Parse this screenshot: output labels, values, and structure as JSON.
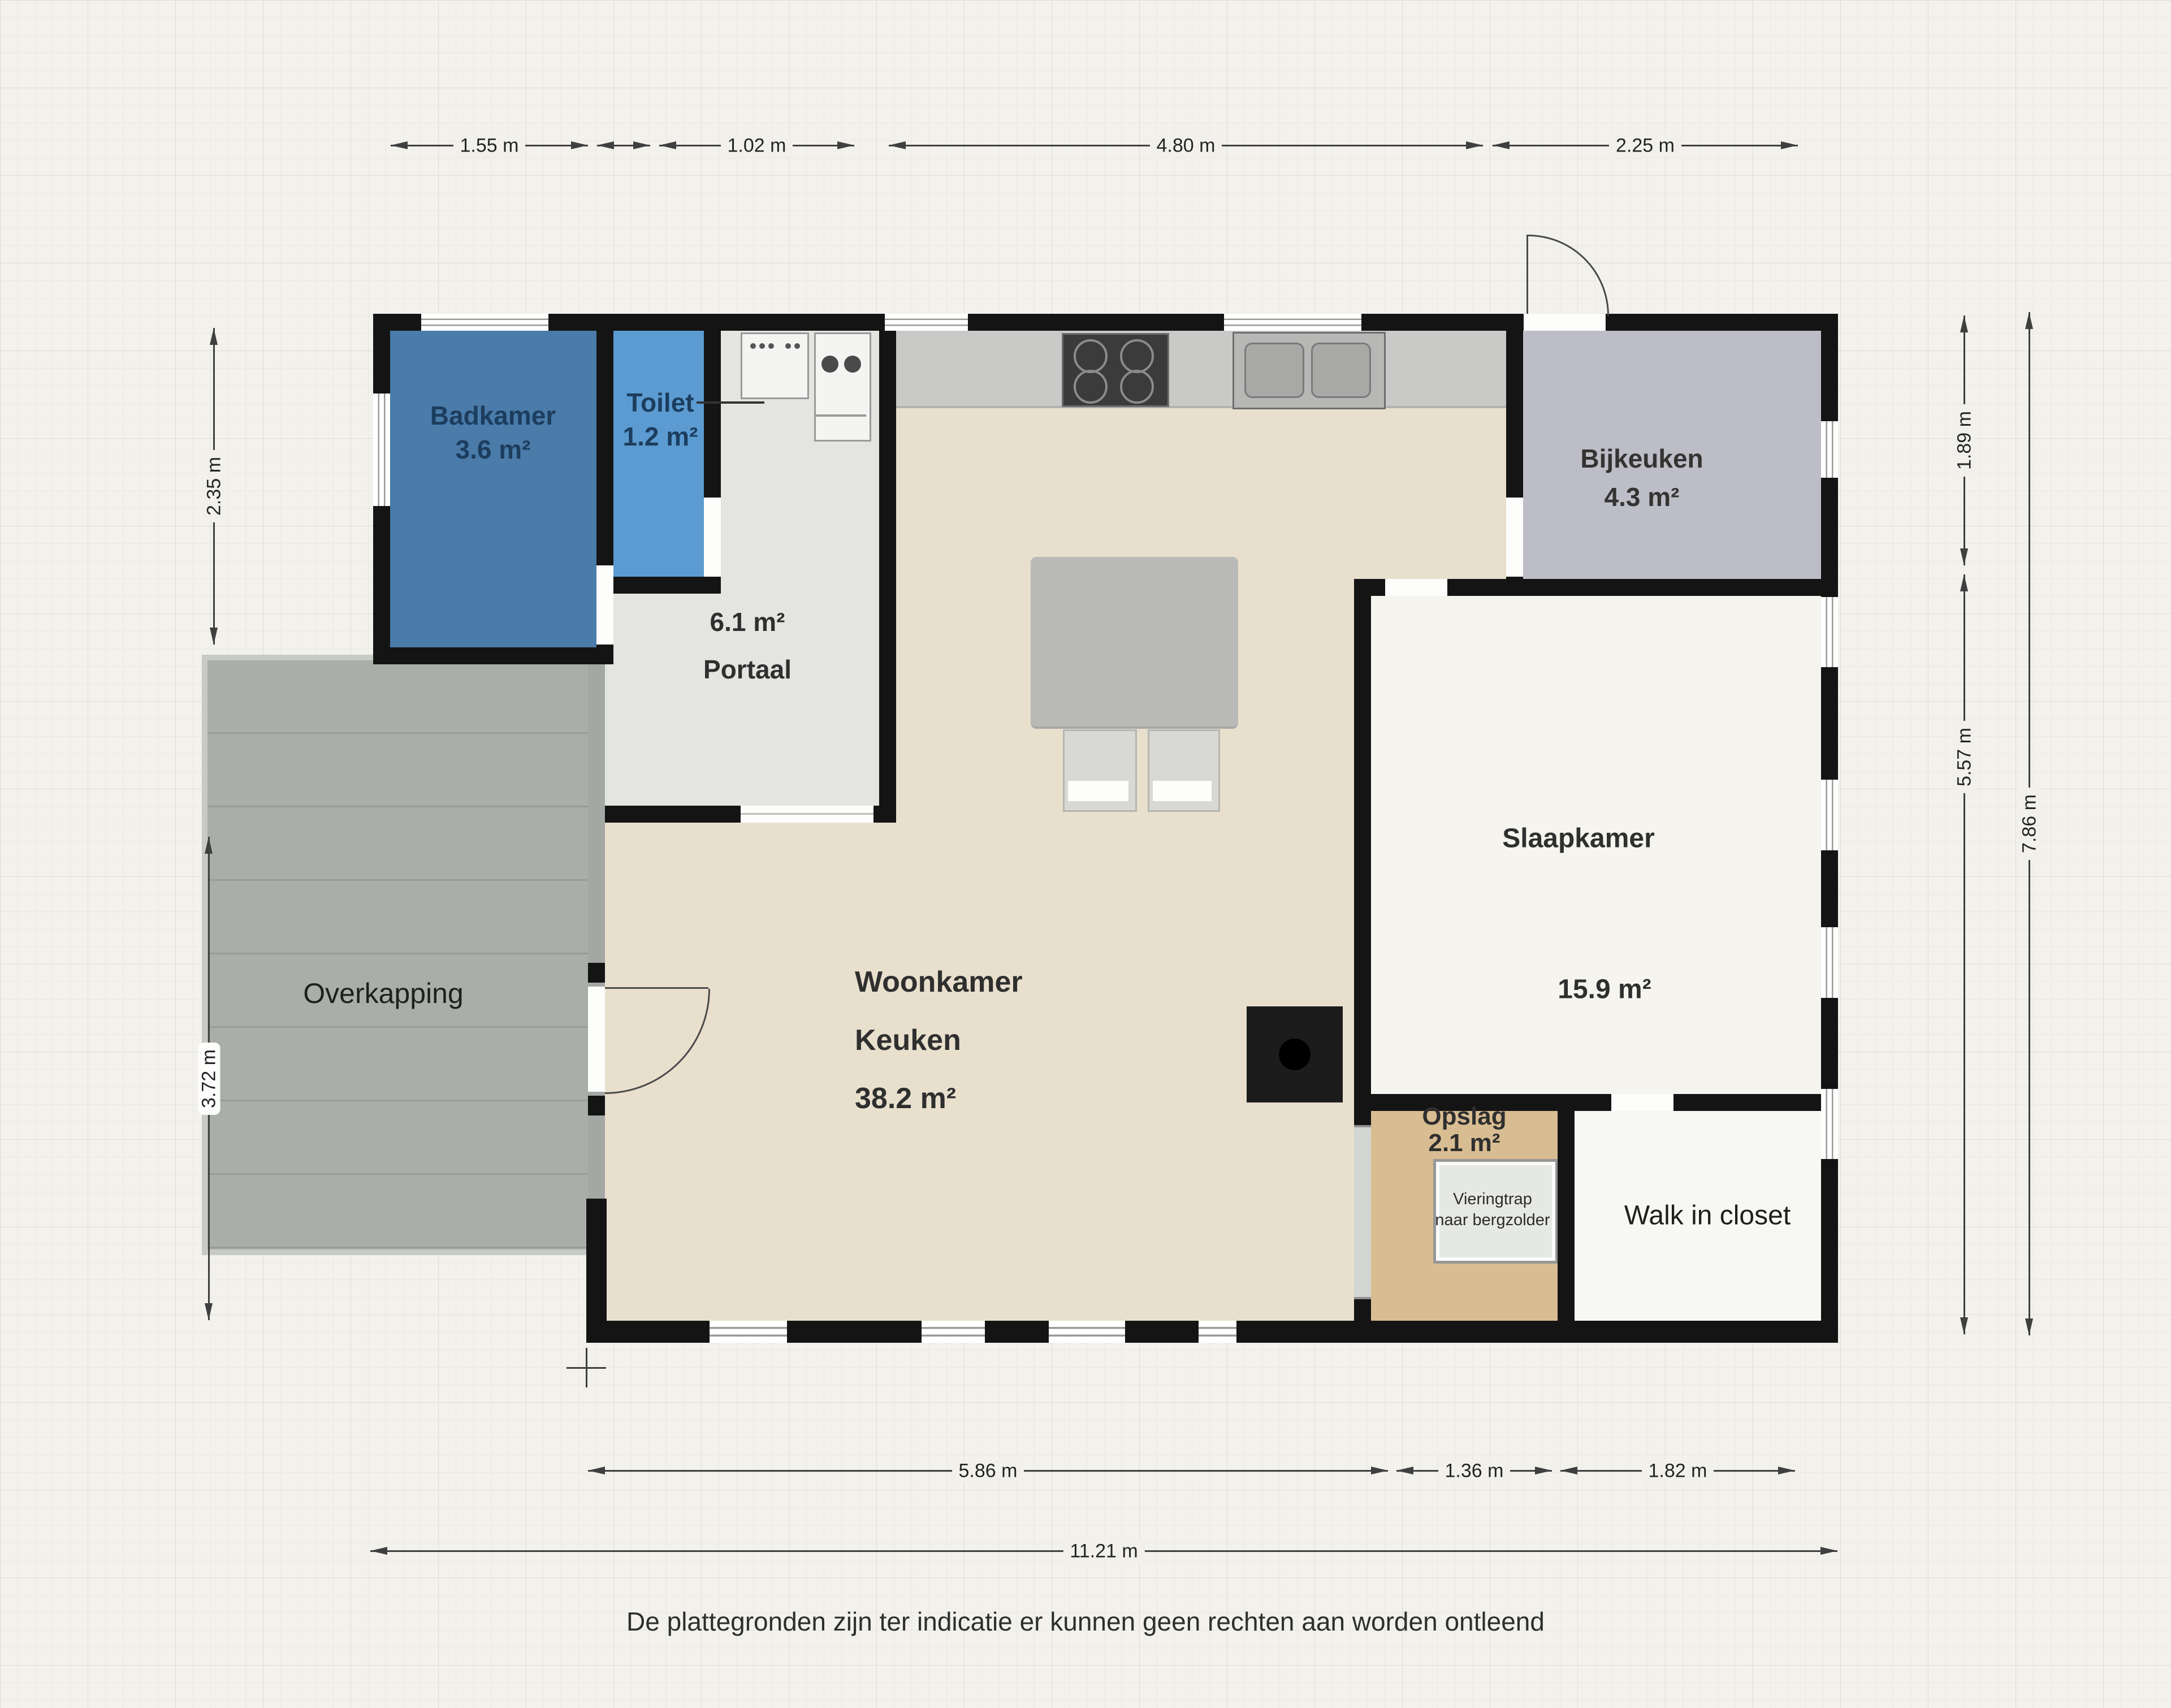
{
  "rooms": {
    "badkamer": {
      "name": "Badkamer",
      "area": "3.6 m²"
    },
    "toilet": {
      "name": "Toilet",
      "area": "1.2 m²"
    },
    "portaal": {
      "area": "6.1 m²",
      "name": "Portaal"
    },
    "bijkeuken": {
      "name": "Bijkeuken",
      "area": "4.3 m²"
    },
    "woonkamer": {
      "line1": "Woonkamer",
      "line2": "Keuken",
      "area": "38.2 m²"
    },
    "slaapkamer": {
      "name": "Slaapkamer",
      "area": "15.9 m²"
    },
    "opslag": {
      "name": "Opslag",
      "area": "2.1 m²"
    },
    "walk_in_closet": {
      "name": "Walk in closet"
    },
    "overkapping": {
      "name": "Overkapping"
    },
    "vieringtrap": {
      "line1": "Vieringtrap",
      "line2": "naar bergzolder"
    }
  },
  "dimensions": {
    "top": [
      "1.55 m",
      "",
      "1.02 m",
      "4.80 m",
      "2.25 m"
    ],
    "left": [
      "2.35 m",
      "3.72 m"
    ],
    "right": [
      "1.89 m",
      "5.57 m",
      "7.86 m"
    ],
    "bottom": [
      "5.86 m",
      "1.36 m",
      "1.82 m",
      "11.21 m"
    ]
  },
  "fixtures": {
    "cooktop": "cooktop-icon",
    "double_sink": "double-sink-icon",
    "washbasin": "washbasin-icon",
    "boiler_sink": "boiler-sink-icon",
    "dining_table": "dining-table",
    "chairs": "chair",
    "wood_stove": "wood-stove-icon",
    "attic_stairs": "attic-stairs-box"
  },
  "colors": {
    "badkamer": "#4a7ba9",
    "toilet": "#5b9bd1",
    "portaal": "#e4e5e1",
    "bijkeuken": "#bdbdc7",
    "woonkamer": "#e8e0cd",
    "slaapkamer": "#f5f4ee",
    "opslag": "#d9bd92",
    "walk_in_closet": "#f7f7f3",
    "overkapping": "#a9aea9",
    "wall": "#141414",
    "label_blue": "#1c3d5e",
    "label_dark": "#2f2f2f"
  },
  "disclaimer": "De plattegronden zijn ter indicatie er kunnen geen rechten aan worden ontleend"
}
